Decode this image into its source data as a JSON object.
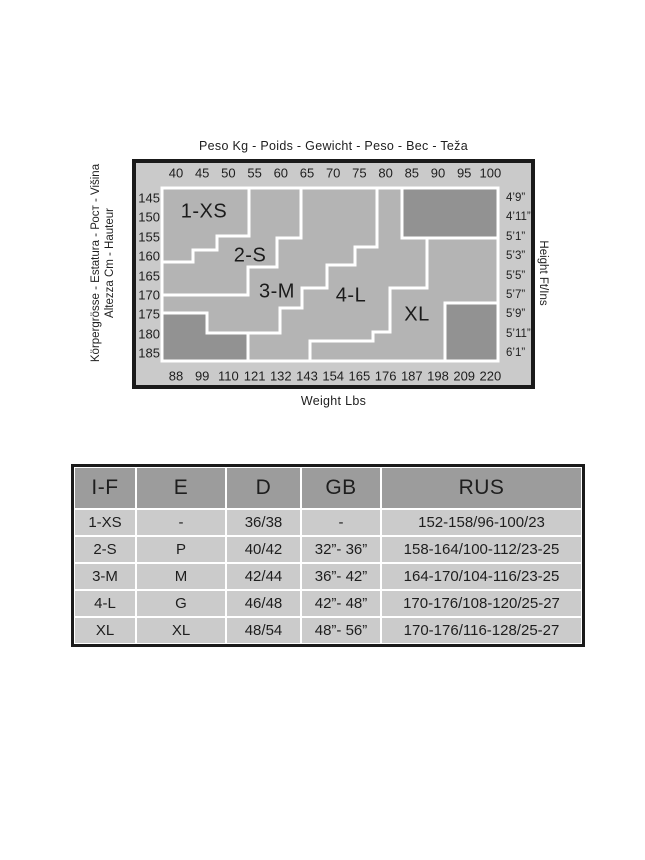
{
  "page": {
    "background": "#ffffff"
  },
  "chart_data": {
    "type": "zone-map",
    "description": "Size selection chart mapping body weight (Kg top axis / Lbs bottom axis) against body height (Cm left axis / Ft-Ins right axis) into size zones; dark grey corner regions are outside the size range",
    "title": "Peso Kg - Poids - Gewicht - Peso - Bec - Teža",
    "bottom_axis_title": "Weight Lbs",
    "right_axis_title": "Height Ft/Ins",
    "left_axis_title_outer": "Körpergrösse - Estatura - Рост - Višina",
    "left_axis_title_inner": "Altezza Cm - Hauteur",
    "x_top_ticks_kg": [
      "40",
      "45",
      "50",
      "55",
      "60",
      "65",
      "70",
      "75",
      "80",
      "85",
      "90",
      "95",
      "100"
    ],
    "x_bottom_ticks_lbs": [
      "88",
      "99",
      "110",
      "121",
      "132",
      "143",
      "154",
      "165",
      "176",
      "187",
      "198",
      "209",
      "220"
    ],
    "y_left_ticks_cm": [
      "145",
      "150",
      "155",
      "160",
      "165",
      "170",
      "175",
      "180",
      "185"
    ],
    "y_right_ticks_ftin": [
      "4’9”",
      "4’11”",
      "5’1”",
      "5’3”",
      "5’5”",
      "5’7”",
      "5’9”",
      "5’11”",
      "6’1”"
    ],
    "colors": {
      "frame_border": "#1a1a1a",
      "frame_bg": "#cacaca",
      "zone_fill": "#b4b4b4",
      "dark_fill": "#929292",
      "zone_line": "#ffffff",
      "text": "#1e1e1e"
    },
    "zones": [
      {
        "label": "1-XS",
        "label_pos": [
          204,
          212
        ],
        "points": [
          [
            162,
            188
          ],
          [
            249,
            188
          ],
          [
            249,
            236
          ],
          [
            217,
            236
          ],
          [
            217,
            250
          ],
          [
            193,
            250
          ],
          [
            193,
            262
          ],
          [
            162,
            262
          ]
        ]
      },
      {
        "label": "2-S",
        "label_pos": [
          250,
          256
        ],
        "points": [
          [
            249,
            188
          ],
          [
            301,
            188
          ],
          [
            301,
            238
          ],
          [
            277,
            238
          ],
          [
            277,
            267
          ],
          [
            248,
            267
          ],
          [
            248,
            295
          ],
          [
            162,
            295
          ],
          [
            162,
            262
          ],
          [
            193,
            262
          ],
          [
            193,
            250
          ],
          [
            217,
            250
          ],
          [
            217,
            236
          ],
          [
            249,
            236
          ]
        ]
      },
      {
        "label": "3-M",
        "label_pos": [
          277,
          292
        ],
        "points": [
          [
            301,
            188
          ],
          [
            377,
            188
          ],
          [
            377,
            247
          ],
          [
            355,
            247
          ],
          [
            355,
            265
          ],
          [
            327,
            265
          ],
          [
            327,
            288
          ],
          [
            302,
            288
          ],
          [
            302,
            308
          ],
          [
            280,
            308
          ],
          [
            280,
            333
          ],
          [
            207,
            333
          ],
          [
            207,
            313
          ],
          [
            162,
            313
          ],
          [
            162,
            295
          ],
          [
            248,
            295
          ],
          [
            248,
            267
          ],
          [
            277,
            267
          ],
          [
            277,
            238
          ],
          [
            301,
            238
          ]
        ]
      },
      {
        "label": "4-L",
        "label_pos": [
          351,
          296
        ],
        "points": [
          [
            377,
            188
          ],
          [
            402,
            188
          ],
          [
            402,
            238
          ],
          [
            427,
            238
          ],
          [
            427,
            288
          ],
          [
            390,
            288
          ],
          [
            390,
            332
          ],
          [
            373,
            332
          ],
          [
            373,
            341
          ],
          [
            310,
            341
          ],
          [
            310,
            361
          ],
          [
            248,
            361
          ],
          [
            248,
            333
          ],
          [
            280,
            333
          ],
          [
            280,
            308
          ],
          [
            302,
            308
          ],
          [
            302,
            288
          ],
          [
            327,
            288
          ],
          [
            327,
            265
          ],
          [
            355,
            265
          ],
          [
            355,
            247
          ],
          [
            377,
            247
          ]
        ]
      },
      {
        "label": "XL",
        "label_pos": [
          417,
          315
        ],
        "points": [
          [
            427,
            238
          ],
          [
            498,
            238
          ],
          [
            498,
            303
          ],
          [
            445,
            303
          ],
          [
            445,
            361
          ],
          [
            310,
            361
          ],
          [
            310,
            341
          ],
          [
            373,
            341
          ],
          [
            373,
            332
          ],
          [
            390,
            332
          ],
          [
            390,
            288
          ],
          [
            427,
            288
          ]
        ]
      }
    ],
    "excluded_regions": [
      {
        "points": [
          [
            402,
            188
          ],
          [
            498,
            188
          ],
          [
            498,
            238
          ],
          [
            402,
            238
          ]
        ]
      },
      {
        "points": [
          [
            162,
            313
          ],
          [
            207,
            313
          ],
          [
            207,
            333
          ],
          [
            248,
            333
          ],
          [
            248,
            361
          ],
          [
            162,
            361
          ]
        ]
      },
      {
        "points": [
          [
            445,
            303
          ],
          [
            498,
            303
          ],
          [
            498,
            361
          ],
          [
            445,
            361
          ]
        ]
      }
    ]
  },
  "size_table": {
    "headers": [
      "I-F",
      "E",
      "D",
      "GB",
      "RUS"
    ],
    "col_widths": [
      62,
      90,
      75,
      80,
      201
    ],
    "rows": [
      [
        "1-XS",
        "-",
        "36/38",
        "-",
        "152-158/96-100/23"
      ],
      [
        "2-S",
        "P",
        "40/42",
        "32”- 36”",
        "158-164/100-112/23-25"
      ],
      [
        "3-M",
        "M",
        "42/44",
        "36”- 42”",
        "164-170/104-116/23-25"
      ],
      [
        "4-L",
        "G",
        "46/48",
        "42”- 48”",
        "170-176/108-120/25-27"
      ],
      [
        "XL",
        "XL",
        "48/54",
        "48”- 56”",
        "170-176/116-128/25-27"
      ]
    ]
  }
}
